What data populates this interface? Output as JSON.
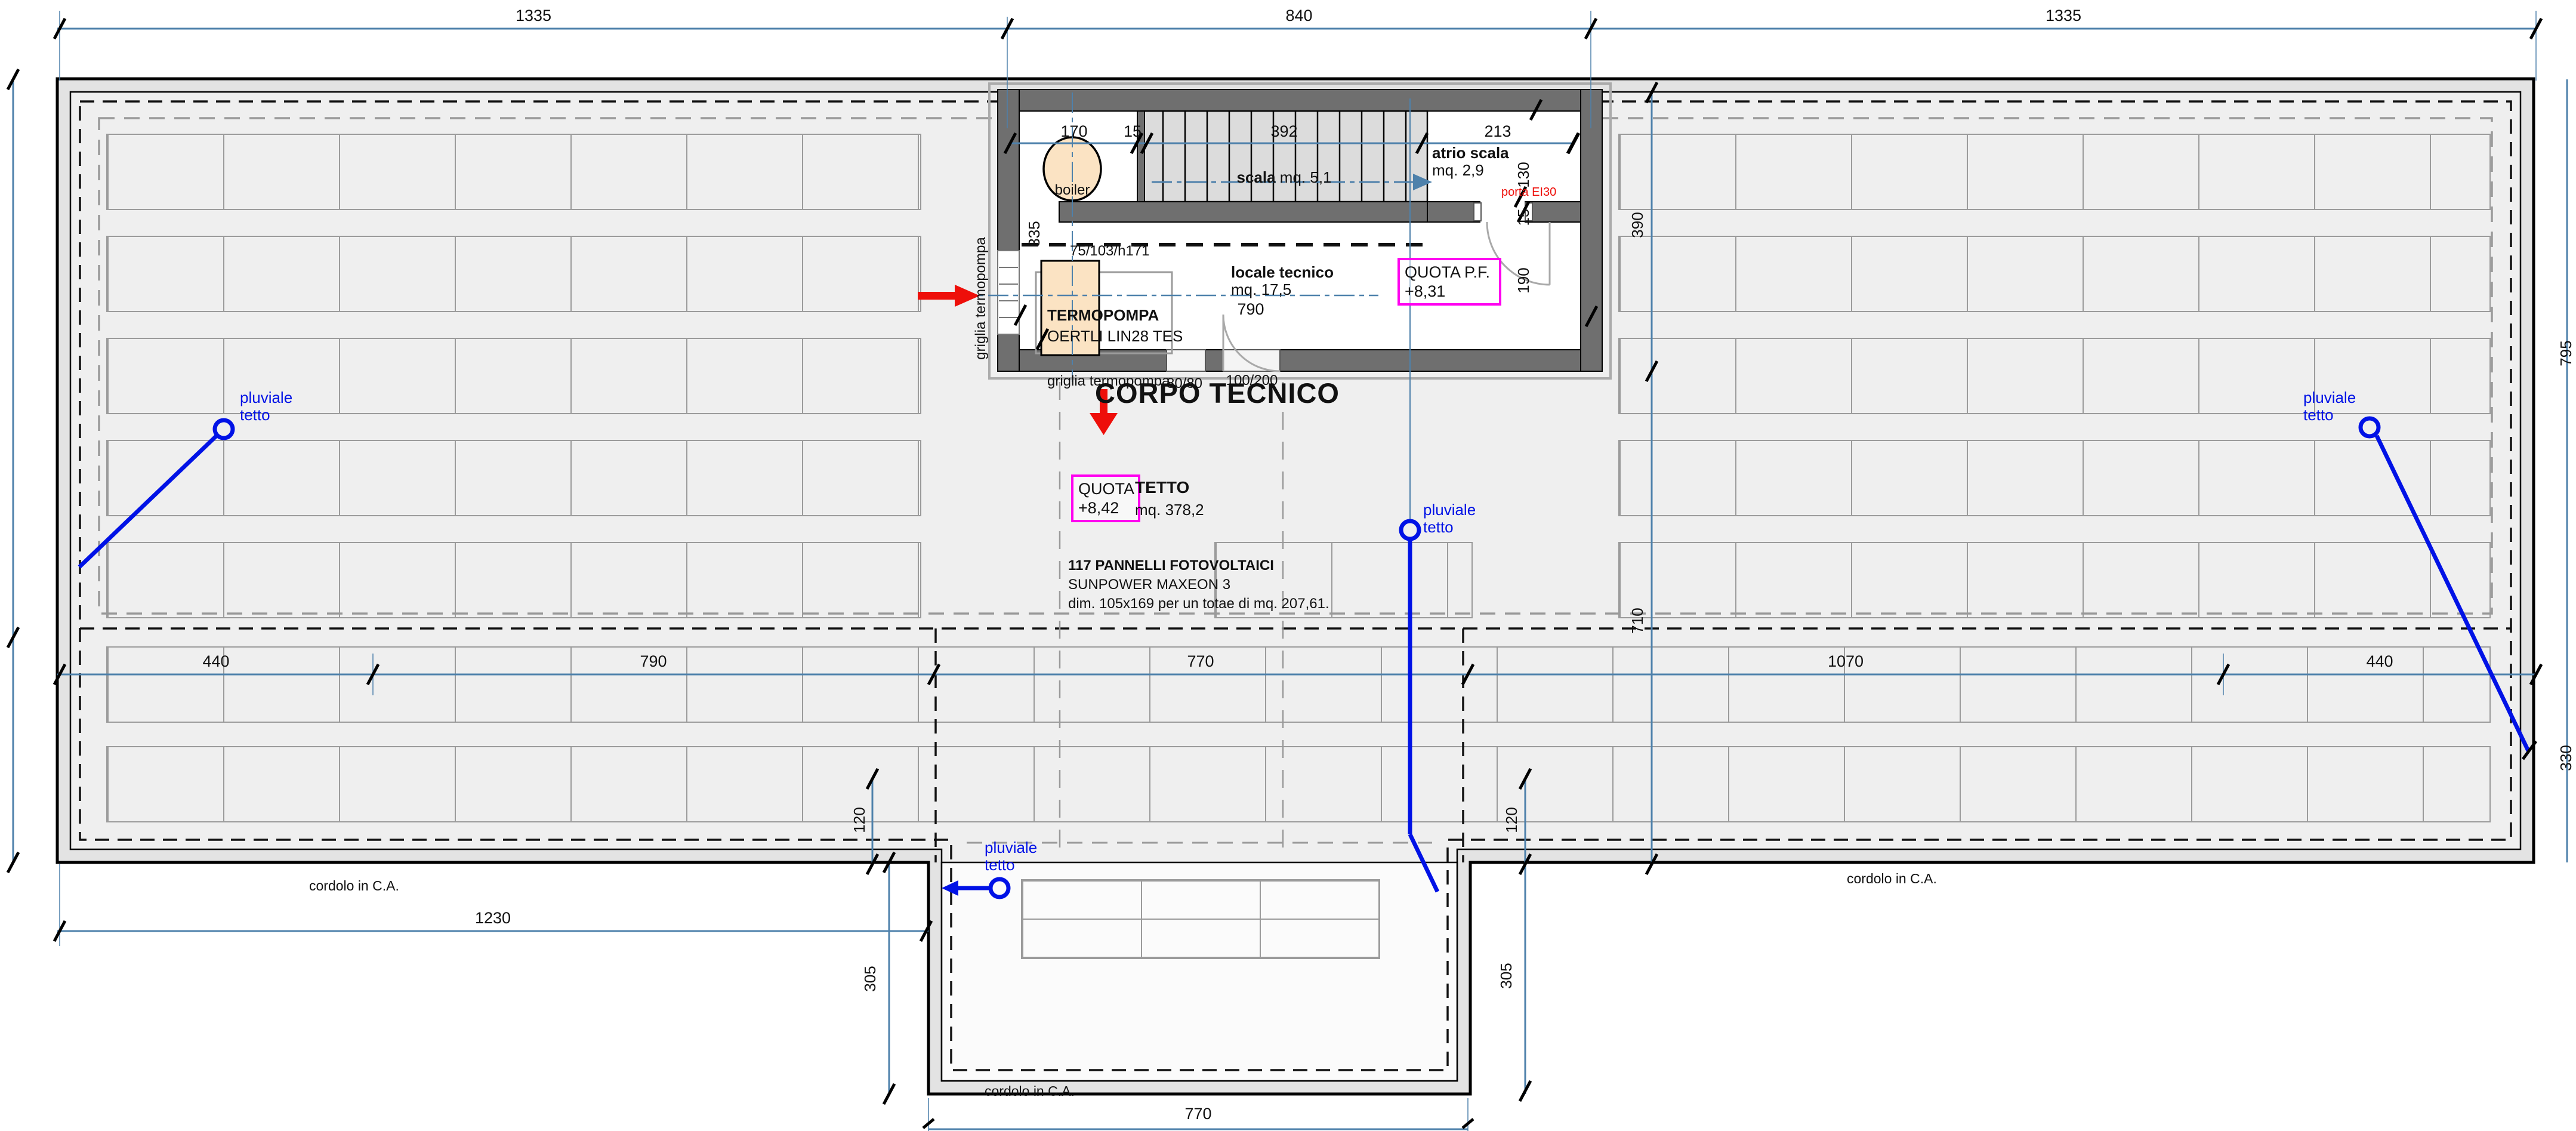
{
  "drawing": {
    "title": "CORPO TECNICO",
    "tetto_name": "TETTO",
    "tetto_area": "mq. 378,2",
    "quota_line1": "QUOTA",
    "quota_line2": "+8,42",
    "pannelli_line1": "117 PANNELLI FOTOVOLTAICI",
    "pannelli_line2": "SUNPOWER MAXEON 3",
    "pannelli_line3": "dim. 105x169 per un totae di mq. 207,61.",
    "pluviale_line1": "pluviale",
    "pluviale_line2": "tetto",
    "cordolo": "cordolo in C.A.",
    "griglia": "griglia termopompa"
  },
  "dims": {
    "top": [
      "1335",
      "840",
      "1335"
    ],
    "middle": [
      "440",
      "790",
      "770",
      "1070",
      "440"
    ],
    "bottom_left": "1230",
    "bottom_center": "770",
    "v_left_120": "120",
    "v_right_120": "120",
    "v_left_305": "305",
    "v_right_305": "305",
    "v_710": "710",
    "v_390": "390",
    "v_right_795": "795",
    "v_right_330": "330"
  },
  "corpo": {
    "top_dims": [
      "170",
      "15",
      "392",
      "213"
    ],
    "dim_130": "130",
    "dim_15": "15",
    "dim_190": "190",
    "dim_335": "335",
    "dim_790": "790",
    "boiler": "boiler",
    "scala_name": "scala",
    "scala_area": "mq. 5,1",
    "atrio_name": "atrio scala",
    "atrio_area": "mq. 2,9",
    "locale_name": "locale tecnico",
    "locale_area": "mq. 17,5",
    "termopompa_line1": "TERMOPOMPA",
    "termopompa_line2": "OERTLI LIN28 TES",
    "termopompa_size": "75/103/h171",
    "porta_label": "porta EI30",
    "opening_8080": "80/80",
    "opening_100200": "100/200",
    "quota_pf_line1": "QUOTA P.F.",
    "quota_pf_line2": "+8,31"
  },
  "colors": {
    "dim_line": "#4e81ab",
    "pluviale_blue": "#0012e6",
    "accent_red": "#ee0f0a",
    "accent_magenta": "#ff00f0",
    "wall_gray": "#6f6f6f",
    "panel_line": "#9b9b9b",
    "equipment_fill": "#fbe3c3"
  }
}
